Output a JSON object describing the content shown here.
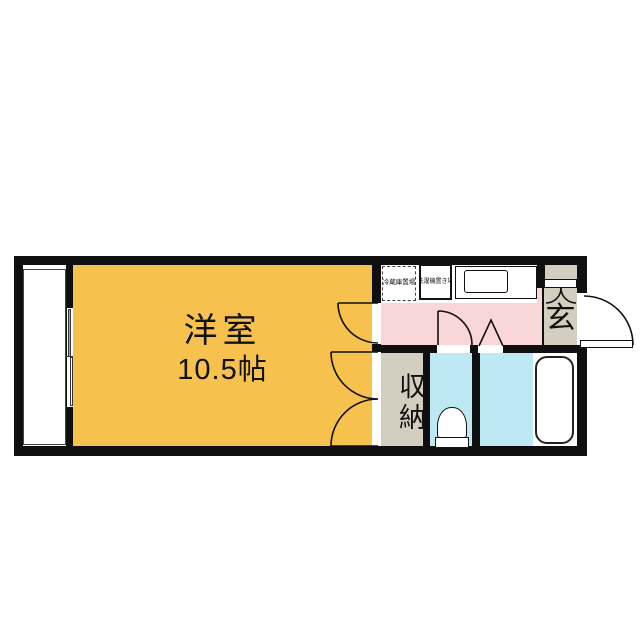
{
  "plan": {
    "type": "apartment-floor-plan",
    "rooms": {
      "living": {
        "label": "洋室",
        "area": "10.5帖"
      },
      "closet": {
        "label": "収納"
      },
      "entrance": {
        "label": "玄"
      },
      "kitchen": {
        "fridge_label": "冷蔵庫置場",
        "washer_label": "洗濯機置き場"
      }
    },
    "colors": {
      "wall": "#0f0f0f",
      "living": "#f6c14d",
      "kitchen": "#f9d6d7",
      "wet": "#bce9f4",
      "tan": "#d4cec0",
      "white": "#ffffff",
      "pane": "#a9a9a9"
    }
  }
}
